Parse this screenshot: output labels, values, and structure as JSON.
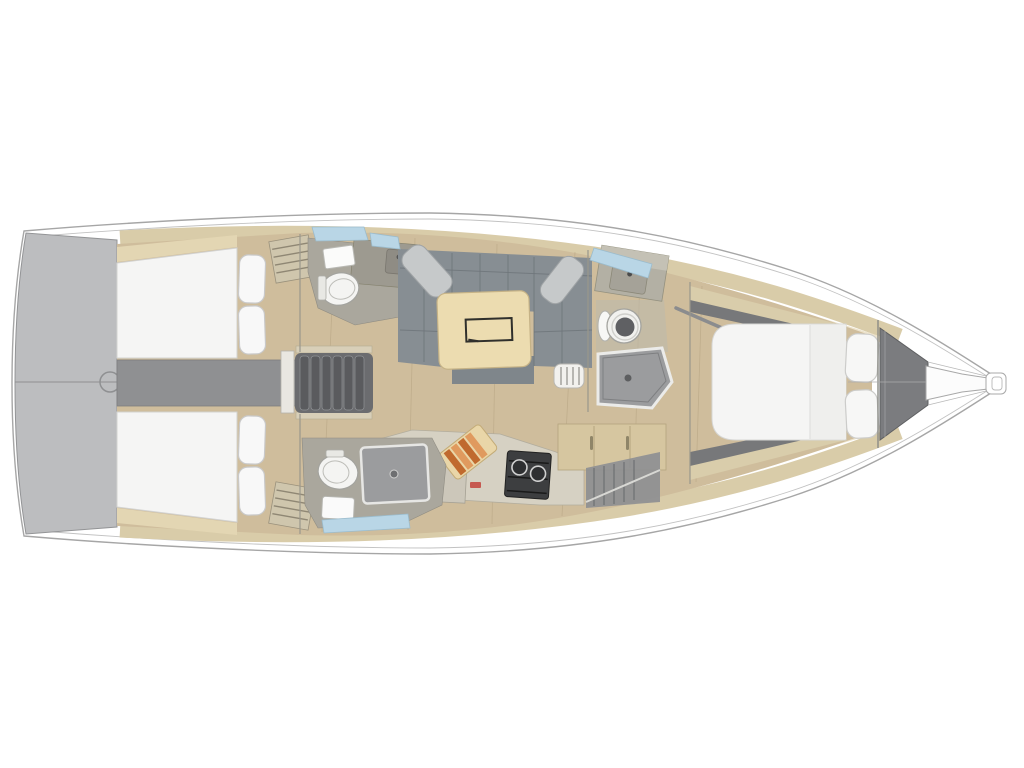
{
  "meta": {
    "description": "Top-down 3D-rendered interior floor plan of a sailing yacht, bow pointing right, no visible text labels",
    "orientation": "bow-right"
  },
  "palette": {
    "page_bg": "#ffffff",
    "hull_fill": "#ffffff",
    "hull_stroke": "#a6a6a6",
    "transom_gray": "#bcbdbf",
    "deck_tan": "#d9cca9",
    "trim_cream": "#ece2c8",
    "floor_wood": "#cfbd9c",
    "dark_band": "#77787a",
    "corridor_gray": "#8f9092",
    "steps_dark": "#5a5b5e",
    "bed_white": "#f5f5f4",
    "pillow_white": "#f8f8f8",
    "sofa_gray": "#878e93",
    "sofa_pillow_gray": "#c6c9ca",
    "table_wood": "#ecdcb0",
    "head_gray": "#aaa79d",
    "counter_gray": "#b3b0a4",
    "fixture_white": "#f4f4f2",
    "shower_gray": "#9b9c9e",
    "stove_dark": "#3d3e40",
    "board_orange": "#c06a2e",
    "board_orange_light": "#e09a5e",
    "window_blue": "#b9d6e6",
    "accent_red": "#c23b33",
    "cabinet_tan": "#d6c6a0",
    "anchor_locker_gray": "#7b7c7f"
  },
  "elements": [
    {
      "id": "swim-platform",
      "kind": "transom swim platform"
    },
    {
      "id": "aft-cabin-port",
      "kind": "aft double cabin with pillows"
    },
    {
      "id": "aft-cabin-starboard",
      "kind": "aft double cabin with pillows"
    },
    {
      "id": "companionway-steps",
      "kind": "companionway stairs over engine box"
    },
    {
      "id": "aft-head-port",
      "kind": "toilet compartment with sink"
    },
    {
      "id": "aft-head-starboard",
      "kind": "toilet compartment with shower"
    },
    {
      "id": "saloon",
      "kind": "U-shaped settee with table and cushions"
    },
    {
      "id": "galley",
      "kind": "galley with sink, stove and cutting board"
    },
    {
      "id": "forward-head",
      "kind": "forward toilet compartment with shower pan"
    },
    {
      "id": "forward-cabin",
      "kind": "V-berth double bed with pillows"
    },
    {
      "id": "anchor-locker",
      "kind": "bow anchor locker"
    },
    {
      "id": "bowsprit",
      "kind": "bowsprit at bow tip"
    }
  ]
}
